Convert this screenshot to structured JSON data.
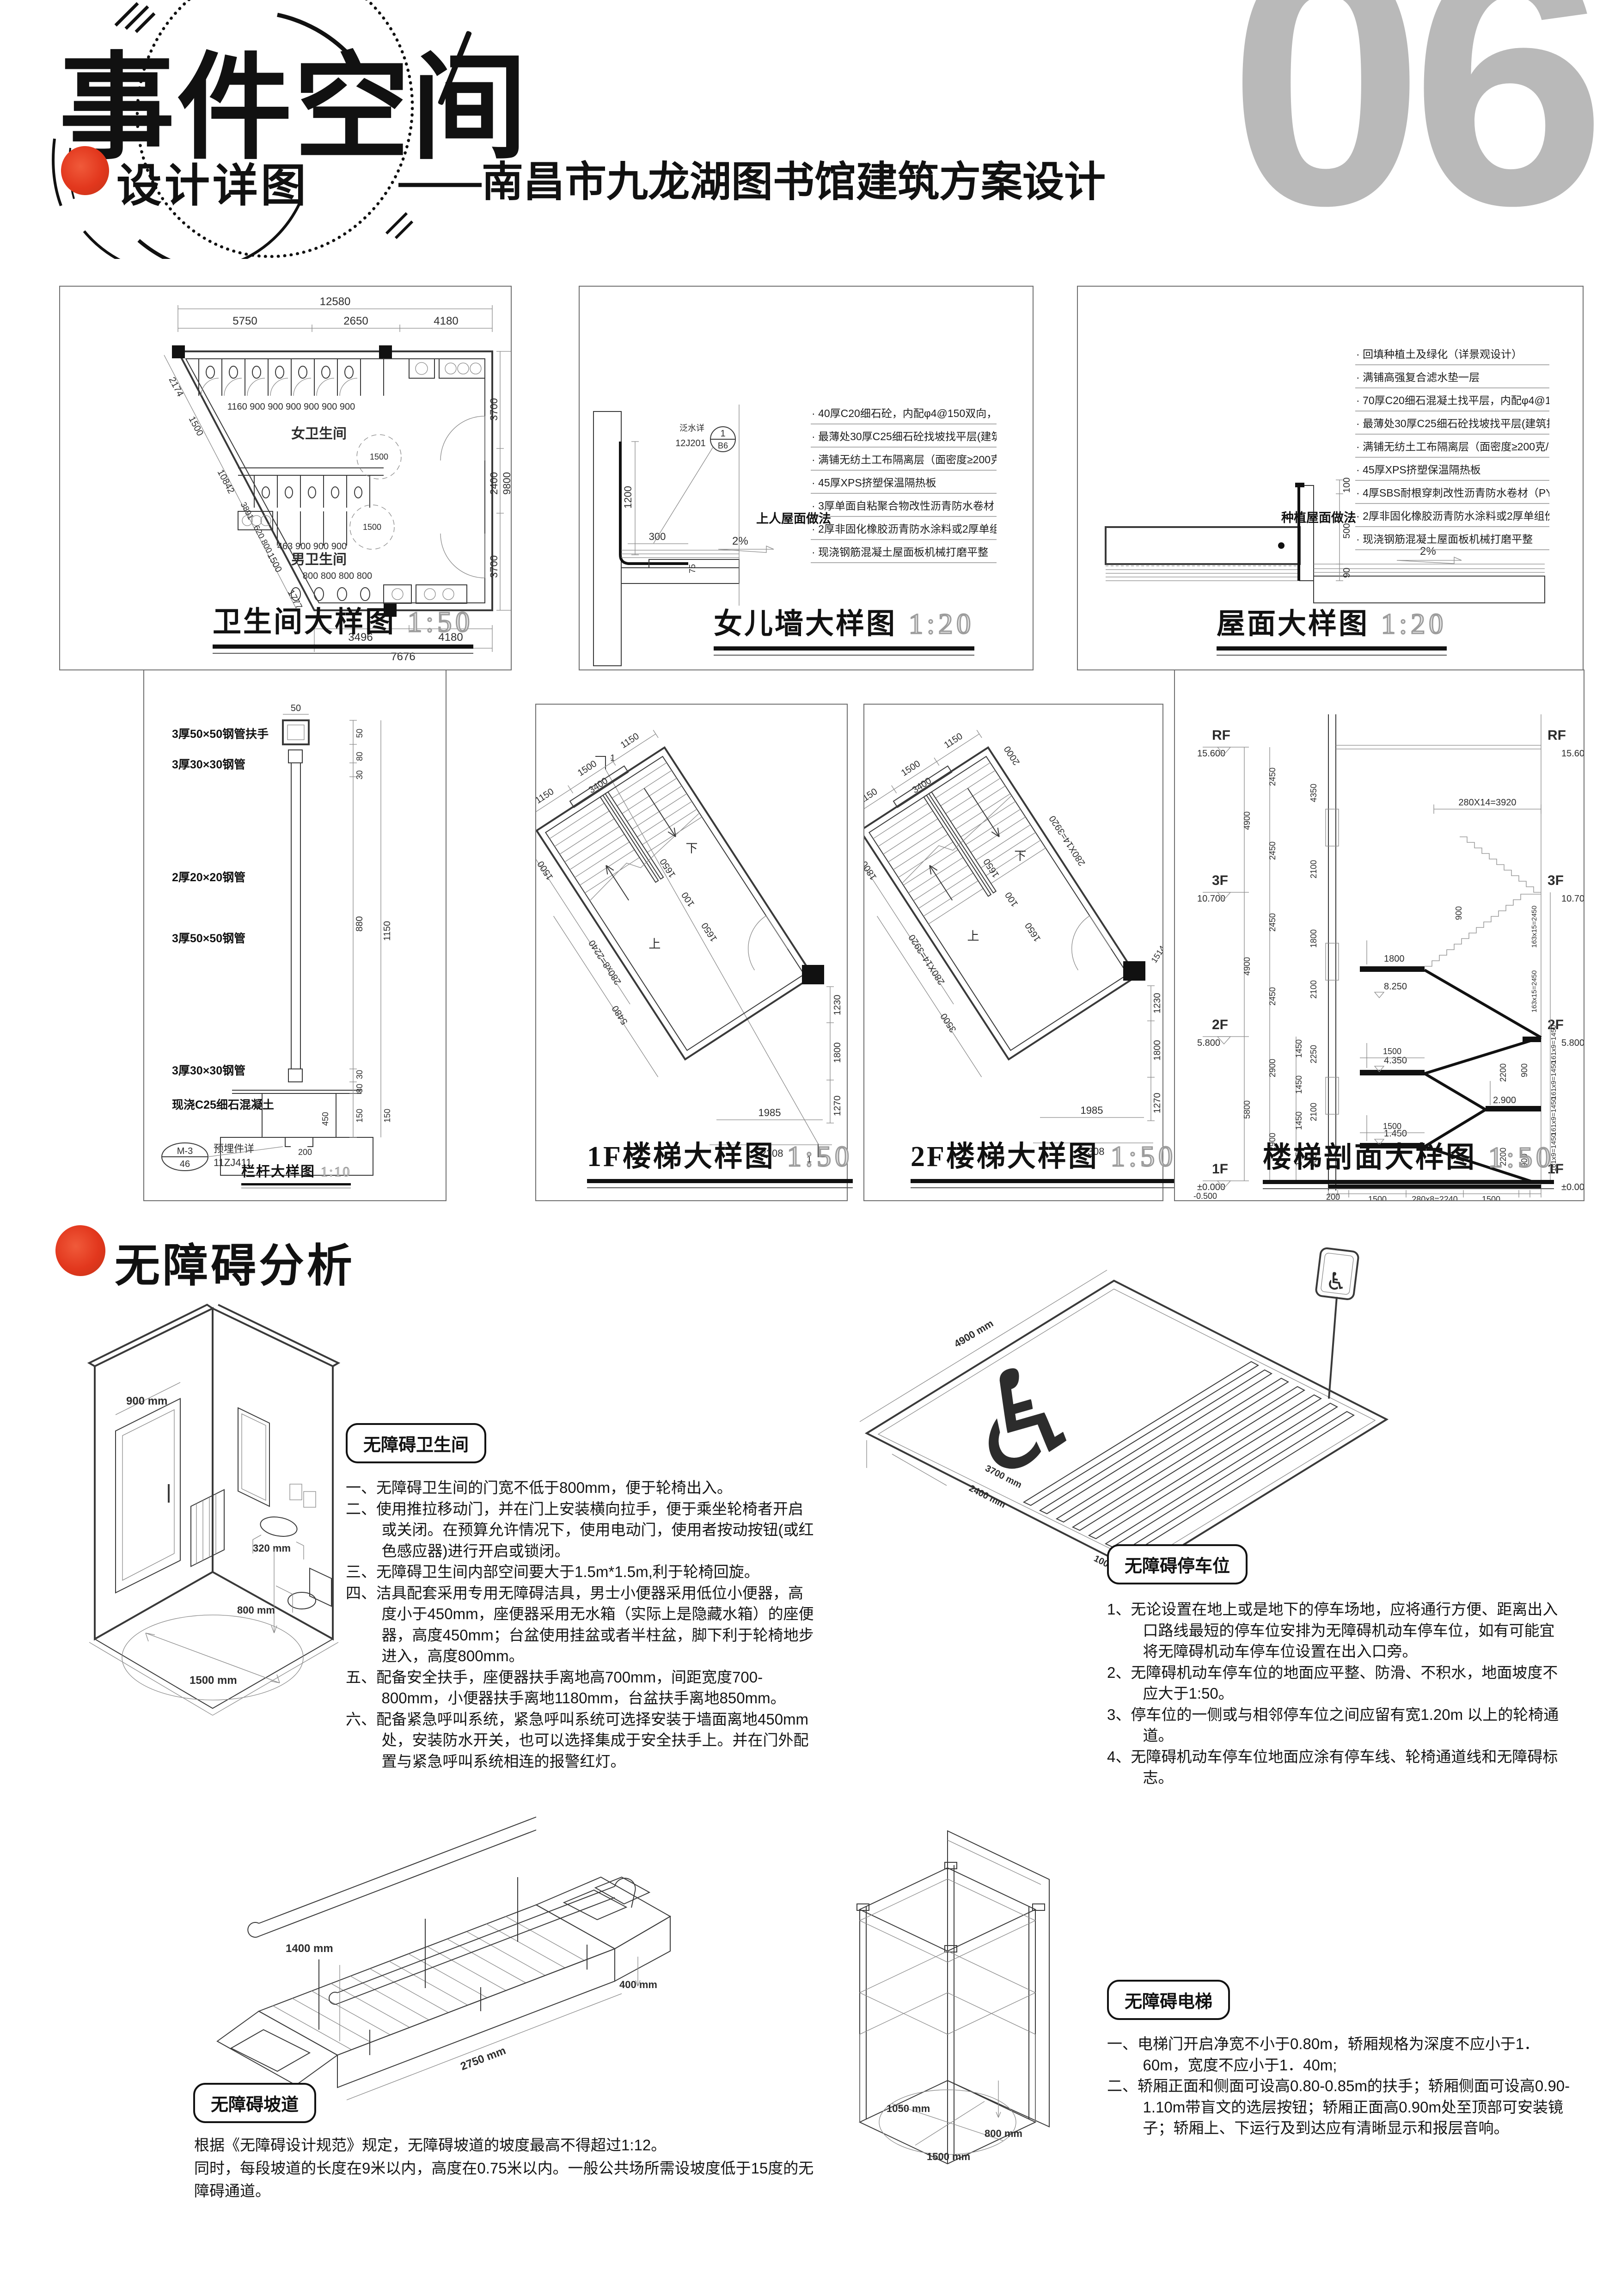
{
  "page": {
    "number": "06"
  },
  "header": {
    "title": "事件空间",
    "subtitle": "——南昌市九龙湖图书馆建筑方案设计"
  },
  "section1": {
    "title": "设计详图"
  },
  "section2": {
    "title": "无障碍分析"
  },
  "icons": {
    "wheelchair": "♿"
  },
  "colors": {
    "accent_red": "#e2371d",
    "page_number_gray": "#b9b9b9",
    "line": "#3a3a3a"
  },
  "toilet_plan": {
    "title": "卫生间大样图",
    "scale": "1:50",
    "female": "女卫生间",
    "male": "男卫生间",
    "dim_top_total": "12580",
    "dim_top1": "5750",
    "dim_top2": "2650",
    "dim_top3": "4180",
    "dim_right1": "3700",
    "dim_right2": "2400",
    "dim_right3": "3700",
    "dim_right_total": "9800",
    "dim_bottom1": "3496",
    "dim_bottom2": "4180",
    "dim_bottom_total": "7676",
    "stall_dims": "1160   900   900   900   900   900   900",
    "male_dims": "463  900   900   900",
    "urinal_dims": "800   800   800   800",
    "diag1": "2174",
    "diag2": "1500",
    "diag3": "10842",
    "diag4": "3891",
    "diag5": "620  800",
    "diag6": "1500",
    "diag7": "1777",
    "circle1": "1500",
    "circle2": "1500"
  },
  "parapet": {
    "title": "女儿墙大样图",
    "scale": "1:20",
    "side_label": "上人屋面做法",
    "bubble_top": "1",
    "bubble_bottom": "B6",
    "bubble_code": "12J201",
    "bubble_note": "泛水详",
    "dim_h": "1200",
    "dim_w": "300",
    "dim_t": "75",
    "slope": "2%",
    "notes": [
      "40厚C20细石砼，内配φ4@150双向，分隔缝距离≤3m",
      "最薄处30厚C25细石砼找坡找平层(建筑找坡2%)",
      "满铺无纺土工布隔离层（面密度≥200克/平米）",
      "45厚XPS挤塑保温隔热板",
      "3厚单面自粘聚合物改性沥青防水卷材（PY类）",
      "2厚非固化橡胶沥青防水涂料或2厚单组份聚氨酯防水涂料",
      "现浇钢筋混凝土屋面板机械打磨平整"
    ]
  },
  "roof": {
    "title": "屋面大样图",
    "scale": "1:20",
    "side_label": "种植屋面做法",
    "dim_a": "100",
    "dim_b": "500",
    "dim_c": "90",
    "slope": "2%",
    "notes": [
      "回填种植土及绿化（详景观设计）",
      "满铺高强复合滤水垫一层",
      "70厚C20细石混凝土找平层，内配φ4@150钢筋网片",
      "最薄处30厚C25细石砼找坡找平层(建筑找坡2%)",
      "满铺无纺土工布隔离层（面密度≥200克/平米）",
      "45厚XPS挤塑保温隔热板",
      "4厚SBS耐根穿刺改性沥青防水卷材（PY类）",
      "2厚非固化橡胶沥青防水涂料或2厚单组份聚氨酯防水涂料",
      "现浇钢筋混凝土屋面板机械打磨平整"
    ]
  },
  "railing": {
    "title": "栏杆大样图",
    "scale": "1:10",
    "lbl1": "3厚50×50钢管扶手",
    "lbl2": "3厚30×30钢管",
    "lbl3": "2厚20×20钢管",
    "lbl4": "3厚50×50钢管",
    "lbl5": "3厚30×30钢管",
    "lbl6": "现浇C25细石混凝土",
    "bubble_top": "M-3",
    "bubble_bottom": "46",
    "ref1": "预埋件详",
    "ref2": "11ZJ411",
    "dim_top": "50",
    "r1": "50",
    "r2": "80",
    "r3": "30",
    "r4": "880",
    "r5": "30",
    "r6": "80",
    "r7": "150",
    "total": "1150",
    "base": "150",
    "inner": "450",
    "chan": "200"
  },
  "stair1": {
    "title": "1F楼梯大样图",
    "scale": "1:50",
    "up": "上",
    "down": "下",
    "sec": "1",
    "t1": "1150",
    "t2": "1500",
    "t3": "1150",
    "t4": "3400",
    "l1": "1500",
    "l2": "280x8=2240",
    "l3": "5480",
    "m1": "1650",
    "m2": "100",
    "m3": "1650",
    "rv1": "1230",
    "rv2": "1800",
    "rv3": "1270",
    "b1": "1985",
    "b2": "2308"
  },
  "stair2": {
    "title": "2F楼梯大样图",
    "scale": "1:50",
    "up": "上",
    "down": "下",
    "t1": "1150",
    "t2": "1500",
    "t3": "1150",
    "t4": "3400",
    "t5": "2000",
    "r0": "280X14=3920",
    "l1": "1800",
    "l2": "280X14=3920",
    "l3": "3500",
    "m1": "1650",
    "m2": "100",
    "m3": "1650",
    "rv0": "1514",
    "rv1": "1230",
    "rv2": "1800",
    "rv3": "1270",
    "b1": "1985",
    "b2": "2308"
  },
  "stair_sec": {
    "title": "楼梯剖面大样图",
    "scale": "1:50",
    "lv_rf": "RF",
    "el_rf": "15.600",
    "lv_3f": "3F",
    "el_3f": "10.700",
    "lv_2f": "2F",
    "el_2f": "5.800",
    "lv_1f": "1F",
    "el_1f": "±0.000",
    "el_base": "-0.500",
    "ol1": "4900",
    "ol2": "4900",
    "ol3": "5800",
    "or1": "4900",
    "or2": "4900",
    "or3": "5800",
    "il1": "2450",
    "il2": "2450",
    "il3": "2450",
    "il4": "2450",
    "il5": "2900",
    "il6": "2900",
    "sl1": "1450",
    "sl2": "1450",
    "sl3": "1450",
    "sl4": "1450",
    "ir1": "163x15=2450",
    "ir2": "163x15=2450",
    "ir3": "161x9=1450",
    "ir4": "161x9=1450",
    "ir5": "161x9=1450",
    "ir6": "161x9=1450",
    "ml1": "4350",
    "ml2": "2100",
    "ml3": "1800",
    "ml4": "2100",
    "ml5": "2250",
    "ml6": "2100",
    "ml7": "900",
    "a_run": "280X14=3920",
    "a_1800": "1800",
    "a_8250": "8.250",
    "a_4350": "4.350",
    "a_1450": "1.450",
    "a_2900": "2.900",
    "a_1500a": "1500",
    "a_1500b": "1500",
    "a_900a": "900",
    "a_900b": "900",
    "a_900c": "900",
    "a_2200a": "2200",
    "a_2200b": "2200",
    "bb0": "200",
    "bb1": "240",
    "bb2": "1500",
    "bb3": "280x8=2240",
    "bb4": "1500",
    "bb5": "240"
  },
  "acc_toilet": {
    "label": "无障碍卫生间",
    "items": [
      "一、无障碍卫生间的门宽不低于800mm，便于轮椅出入。",
      "二、使用推拉移动门，并在门上安装横向拉手，便于乘坐轮椅者开启或关闭。在预算允许情况下，使用电动门，使用者按动按钮(或红色感应器)进行开启或锁闭。",
      "三、无障碍卫生间内部空间要大于1.5m*1.5m,利于轮椅回旋。",
      "四、洁具配套采用专用无障碍洁具，男士小便器采用低位小便器，高度小于450mm，座便器采用无水箱（实际上是隐藏水箱）的座便器，高度450mm；台盆使用挂盆或者半柱盆，脚下利于轮椅地步进入，高度800mm。",
      "五、配备安全扶手，座便器扶手离地高700mm，间距宽度700-800mm，小便器扶手离地1180mm，台盆扶手离地850mm。",
      "六、配备紧急呼叫系统，紧急呼叫系统可选择安装于墙面离地450mm处，安装防水开关，也可以选择集成于安全扶手上。并在门外配置与紧急呼叫系统相连的报警红灯。"
    ],
    "d1": "900 mm",
    "d2": "320 mm",
    "d3": "800 mm",
    "d4": "1500 mm"
  },
  "acc_parking": {
    "label": "无障碍停车位",
    "items": [
      "1、无论设置在地上或是地下的停车场地，应将通行方便、距离出入口路线最短的停车位安排为无障碍机动车停车位，如有可能宜将无障碍机动车停车位设置在出入口旁。",
      "2、无障碍机动车停车位的地面应平整、防滑、不积水，地面坡度不应大于1:50。",
      "3、停车位的一侧或与相邻停车位之间应留有宽1.20m 以上的轮椅通道。",
      "4、无障碍机动车停车位地面应涂有停车线、轮椅通道线和无障碍标志。"
    ],
    "d1": "4900 mm",
    "d2": "3700 mm",
    "d3": "2400 mm",
    "d4": "1000 mm"
  },
  "acc_ramp": {
    "label": "无障碍坡道",
    "line1": "根据《无障碍设计规范》规定，无障碍坡道的坡度最高不得超过1:12。",
    "line2": "同时，每段坡道的长度在9米以内，高度在0.75米以内。一般公共场所需设坡度低于15度的无障碍通道。",
    "d1": "1400 mm",
    "d2": "400 mm",
    "d3": "2750 mm"
  },
  "acc_elev": {
    "label": "无障碍电梯",
    "items": [
      "一、电梯门开启净宽不小于0.80m，轿厢规格为深度不应小于1．60m，宽度不应小于1．40m;",
      "二、轿厢正面和侧面可设高0.80-0.85m的扶手；轿厢侧面可设高0.90-1.10m带盲文的选层按钮；轿厢正面高0.90m处至顶部可安装镜子；轿厢上、下运行及到达应有清晰显示和报层音响。"
    ],
    "d1": "1050 mm",
    "d2": "1500 mm",
    "d3": "800 mm"
  }
}
